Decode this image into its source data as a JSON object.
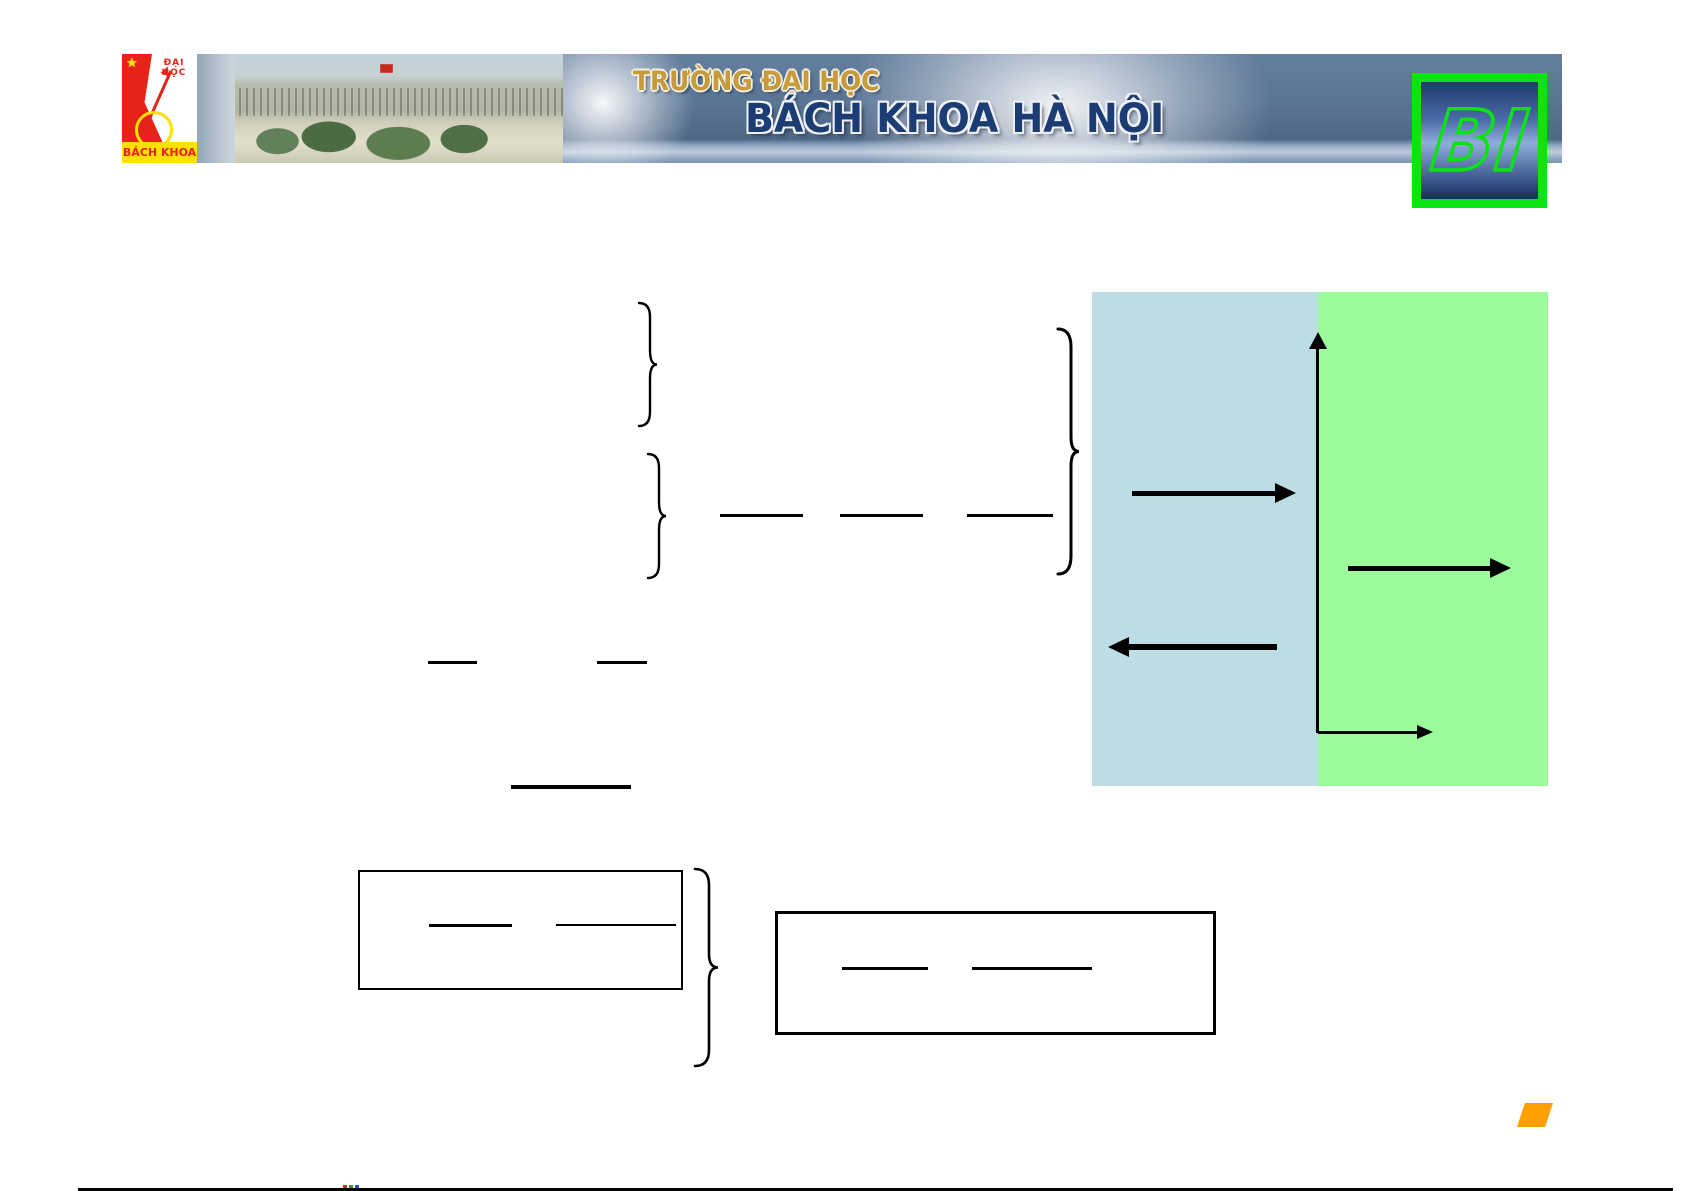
{
  "header": {
    "crest": {
      "star": "★",
      "top_text": "ĐẠI HỌC",
      "bottom_text": "BÁCH KHOA"
    },
    "banner": {
      "title_line1": "TRƯỜNG ĐẠI HỌC",
      "title_line2": "BÁCH KHOA HÀ NỘI"
    },
    "bi_logo": {
      "text": "BI"
    }
  },
  "colors": {
    "crest_red": "#e62317",
    "crest_yellow": "#ffe000",
    "banner_gold": "#c59b3c",
    "banner_navy": "#1c3c74",
    "banner_slate": "#5a7494",
    "bi_green": "#0ce312",
    "region_left_blue": "#bcdde4",
    "region_right_green": "#9bfb9b",
    "shape_orange": "#ff9f00",
    "ink": "#000000"
  }
}
